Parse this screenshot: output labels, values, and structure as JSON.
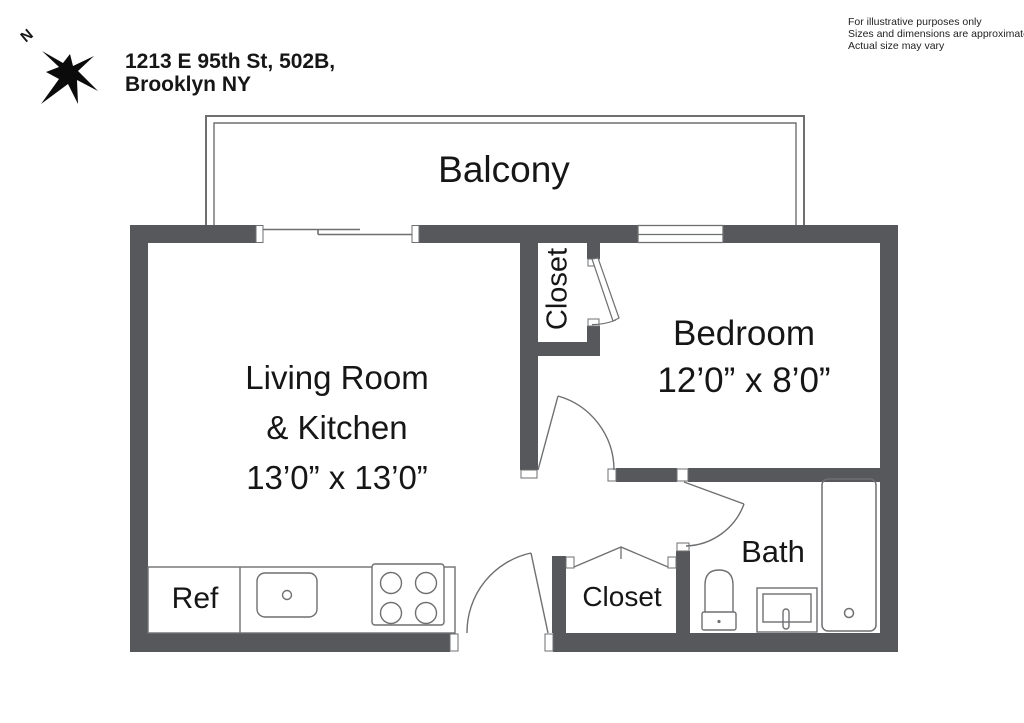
{
  "header": {
    "address_line1": "1213 E 95th St, 502B,",
    "address_line2": "Brooklyn NY",
    "compass_label": "N"
  },
  "disclaimer": {
    "line1": "For illustrative purposes only",
    "line2": "Sizes and dimensions are approximate",
    "line3": "Actual size may vary"
  },
  "rooms": {
    "balcony": {
      "label": "Balcony"
    },
    "living": {
      "name_line1": "Living Room",
      "name_line2": "& Kitchen",
      "dims": "13’0” x 13’0”"
    },
    "bedroom": {
      "label": "Bedroom",
      "dims": "12’0” x 8’0”"
    },
    "closet_top": {
      "label": "Closet"
    },
    "closet_bottom": {
      "label": "Closet"
    },
    "bath": {
      "label": "Bath"
    }
  },
  "fixtures": {
    "refrigerator_label": "Ref"
  },
  "colors": {
    "wall": "#57585c",
    "thin_line": "#6e6f71",
    "text": "#161616"
  }
}
